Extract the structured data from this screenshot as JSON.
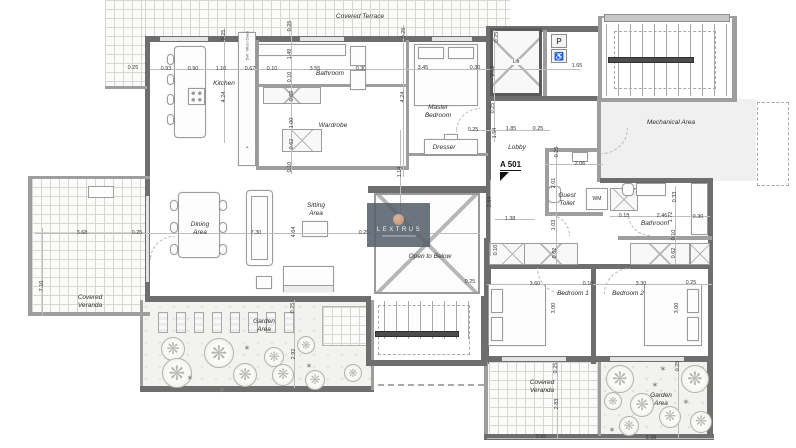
{
  "plan": {
    "marker_label": "A 501",
    "watermark": {
      "brand": "LEXTRUS"
    },
    "fixture_labels": {
      "lift": "Lift",
      "washing_machine": "WM",
      "dishwasher": "DW",
      "micro_oven": "Micro Oven",
      "fridge": "F",
      "parking_sign": "P",
      "wheelchair_sign": "♿"
    },
    "room_labels": [
      {
        "text": "Covered Terrace",
        "x": 360,
        "y": 17,
        "w": 64
      },
      {
        "text": "Kitchen",
        "x": 224,
        "y": 84,
        "w": 50
      },
      {
        "text": "Bathroom",
        "x": 330,
        "y": 74,
        "w": 60
      },
      {
        "text": "Wardrobe",
        "x": 333,
        "y": 126,
        "w": 60
      },
      {
        "text": "Master Bedroom",
        "x": 438,
        "y": 112,
        "w": 44
      },
      {
        "text": "Dresser",
        "x": 444,
        "y": 148,
        "w": 50
      },
      {
        "text": "Lobby",
        "x": 517,
        "y": 148,
        "w": 40
      },
      {
        "text": "Mechanical Area",
        "x": 671,
        "y": 123,
        "w": 52
      },
      {
        "text": "Guest Toilet",
        "x": 567,
        "y": 200,
        "w": 30
      },
      {
        "text": "Bathroom",
        "x": 655,
        "y": 224,
        "w": 60
      },
      {
        "text": "Dining Area",
        "x": 200,
        "y": 229,
        "w": 32
      },
      {
        "text": "Sitting Area",
        "x": 316,
        "y": 210,
        "w": 32
      },
      {
        "text": "Open to Below",
        "x": 430,
        "y": 257,
        "w": 80
      },
      {
        "text": "Bedroom 1",
        "x": 573,
        "y": 294,
        "w": 60
      },
      {
        "text": "Bedroom 2",
        "x": 628,
        "y": 294,
        "w": 60
      },
      {
        "text": "Covered Veranda",
        "x": 90,
        "y": 302,
        "w": 44
      },
      {
        "text": "Garden Area",
        "x": 264,
        "y": 326,
        "w": 36
      },
      {
        "text": "Covered Veranda",
        "x": 542,
        "y": 387,
        "w": 44
      },
      {
        "text": "Garden Area",
        "x": 661,
        "y": 400,
        "w": 36
      }
    ],
    "dimensions": [
      [
        "0.25",
        133,
        68,
        0
      ],
      [
        "0.93",
        166,
        69,
        0
      ],
      [
        "0.90",
        193,
        69,
        0
      ],
      [
        "1.10",
        221,
        69,
        0
      ],
      [
        "0.67",
        250,
        69,
        0
      ],
      [
        "0.10",
        272,
        69,
        0
      ],
      [
        "3.55",
        315,
        69,
        0
      ],
      [
        "0.30",
        361,
        69,
        0
      ],
      [
        "3.45",
        423,
        68,
        0
      ],
      [
        "0.30",
        475,
        68,
        0
      ],
      [
        "1.65",
        577,
        66,
        0
      ],
      [
        "0.25",
        224,
        35,
        1
      ],
      [
        "4.24",
        224,
        97,
        1
      ],
      [
        "0.25",
        290,
        26,
        1
      ],
      [
        "1.49",
        290,
        54,
        1
      ],
      [
        "0.10",
        290,
        77,
        1
      ],
      [
        "0.62",
        292,
        96,
        1
      ],
      [
        "1.00",
        292,
        123,
        1
      ],
      [
        "0.62",
        292,
        144,
        1
      ],
      [
        "0.10",
        290,
        167,
        1
      ],
      [
        "0.25",
        404,
        33,
        1
      ],
      [
        "4.24",
        403,
        97,
        1
      ],
      [
        "1.14",
        400,
        172,
        1
      ],
      [
        "0.25",
        497,
        37,
        1
      ],
      [
        "2.32",
        493,
        71,
        1
      ],
      [
        "0.25",
        493,
        108,
        1
      ],
      [
        "1.54",
        495,
        133,
        1
      ],
      [
        "2.84",
        490,
        202,
        1
      ],
      [
        "0.25",
        473,
        130,
        0
      ],
      [
        "1.85",
        511,
        129,
        0
      ],
      [
        "0.25",
        538,
        129,
        0
      ],
      [
        "2.06",
        580,
        164,
        0
      ],
      [
        "0.26",
        557,
        152,
        1
      ],
      [
        "2.01",
        554,
        183,
        1
      ],
      [
        "1.38",
        510,
        219,
        0
      ],
      [
        "1.03",
        554,
        225,
        1
      ],
      [
        "0.15",
        624,
        216,
        0
      ],
      [
        "2.46",
        662,
        216,
        0
      ],
      [
        "0.30",
        698,
        217,
        0
      ],
      [
        "0.33",
        675,
        197,
        1
      ],
      [
        "1.72",
        671,
        217,
        1
      ],
      [
        "0.10",
        674,
        235,
        1
      ],
      [
        "0.62",
        674,
        253,
        1
      ],
      [
        "0.10",
        496,
        250,
        1
      ],
      [
        "0.62",
        555,
        253,
        1
      ],
      [
        "3.68",
        82,
        233,
        0
      ],
      [
        "0.25",
        137,
        233,
        0
      ],
      [
        "7.10",
        42,
        286,
        1
      ],
      [
        "7.30",
        256,
        233,
        0
      ],
      [
        "4.64",
        294,
        232,
        1
      ],
      [
        "0.25",
        364,
        233,
        0
      ],
      [
        "0.25",
        470,
        282,
        0
      ],
      [
        "3.60",
        535,
        284,
        0
      ],
      [
        "0.10",
        588,
        284,
        0
      ],
      [
        "3.30",
        641,
        284,
        0
      ],
      [
        "0.25",
        691,
        283,
        0
      ],
      [
        "3.00",
        554,
        308,
        1
      ],
      [
        "3.00",
        677,
        308,
        1
      ],
      [
        "0.25",
        293,
        308,
        1
      ],
      [
        "2.92",
        294,
        354,
        1
      ],
      [
        "0.25",
        556,
        368,
        1
      ],
      [
        "2.83",
        557,
        404,
        1
      ],
      [
        "0.25",
        678,
        366,
        1
      ],
      [
        "3.56",
        541,
        437,
        0
      ],
      [
        "3.38",
        651,
        438,
        0
      ]
    ],
    "trees": [
      {
        "x": 172,
        "y": 348,
        "d": 22
      },
      {
        "x": 176,
        "y": 372,
        "d": 28
      },
      {
        "x": 218,
        "y": 352,
        "d": 28
      },
      {
        "x": 244,
        "y": 374,
        "d": 22
      },
      {
        "x": 273,
        "y": 356,
        "d": 18
      },
      {
        "x": 282,
        "y": 374,
        "d": 20
      },
      {
        "x": 305,
        "y": 344,
        "d": 16
      },
      {
        "x": 314,
        "y": 379,
        "d": 18
      },
      {
        "x": 352,
        "y": 372,
        "d": 16
      },
      {
        "x": 619,
        "y": 378,
        "d": 26
      },
      {
        "x": 694,
        "y": 378,
        "d": 26
      },
      {
        "x": 612,
        "y": 400,
        "d": 16
      },
      {
        "x": 641,
        "y": 404,
        "d": 22
      },
      {
        "x": 669,
        "y": 416,
        "d": 20
      },
      {
        "x": 628,
        "y": 425,
        "d": 18
      },
      {
        "x": 700,
        "y": 421,
        "d": 20
      }
    ],
    "tree_marks": [
      {
        "x": 247,
        "y": 348
      },
      {
        "x": 222,
        "y": 390
      },
      {
        "x": 309,
        "y": 366
      },
      {
        "x": 190,
        "y": 378
      },
      {
        "x": 655,
        "y": 385
      },
      {
        "x": 686,
        "y": 402
      },
      {
        "x": 612,
        "y": 430
      },
      {
        "x": 663,
        "y": 369
      }
    ],
    "loungers": [
      158,
      176,
      194,
      212,
      230,
      248,
      266,
      284
    ]
  }
}
